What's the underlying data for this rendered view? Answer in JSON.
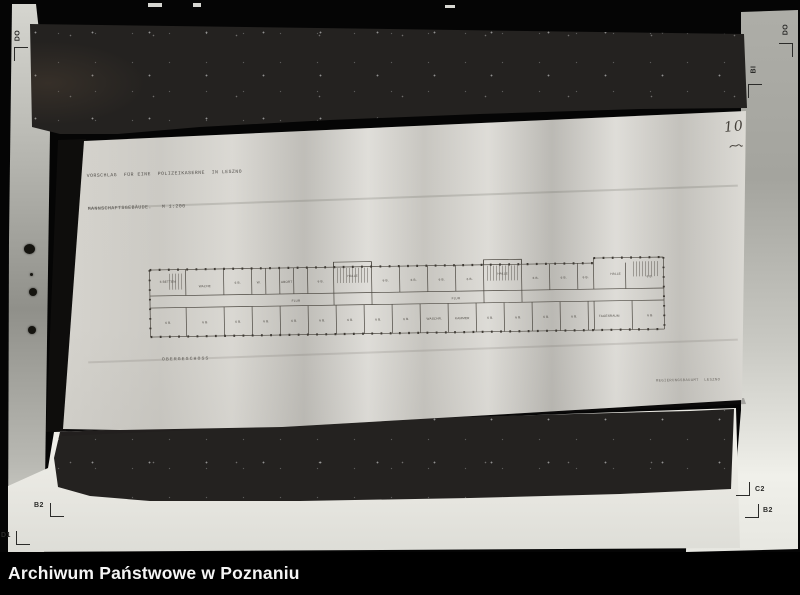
{
  "archive_bar": {
    "label": "Archiwum Państwowe w Poznaniu"
  },
  "paper": {
    "title_line1": "VORSCHLAG  FÜR EINE  POLIZEIKASERNE  IN LESZNO",
    "title_line2": "MANNSCHAFTSGEBÄUDE.   M 1:200",
    "floor_label": "OBERGESCHOSS",
    "office_label": "REGIERUNGSBAUAMT  LESZNO",
    "page_number": "10"
  },
  "registration_marks": {
    "top_left": "DO",
    "top_right": "DO",
    "right_mid": "BI",
    "bottom_left_upper": "B2",
    "bottom_left_lower": "D1",
    "bottom_right_upper": "C2",
    "bottom_right_lower": "B2"
  },
  "floor_plan": {
    "rooms": [
      {
        "x": 22,
        "y": 25,
        "t": "6 BETTEN"
      },
      {
        "x": 59,
        "y": 30,
        "t": "WACHE"
      },
      {
        "x": 92,
        "y": 27,
        "t": "6 B."
      },
      {
        "x": 113,
        "y": 27,
        "t": "W."
      },
      {
        "x": 141,
        "y": 27,
        "t": "ABORT"
      },
      {
        "x": 175,
        "y": 27,
        "t": "6 B."
      },
      {
        "x": 207,
        "y": 22,
        "t": "HALLE"
      },
      {
        "x": 240,
        "y": 27,
        "t": "6 B."
      },
      {
        "x": 268,
        "y": 27,
        "t": "6 B."
      },
      {
        "x": 296,
        "y": 27,
        "t": "6 B."
      },
      {
        "x": 324,
        "y": 27,
        "t": "6 B."
      },
      {
        "x": 357,
        "y": 22,
        "t": "HALLE"
      },
      {
        "x": 390,
        "y": 27,
        "t": "6 B."
      },
      {
        "x": 418,
        "y": 27,
        "t": "6 B."
      },
      {
        "x": 440,
        "y": 27,
        "t": "6 B."
      },
      {
        "x": 470,
        "y": 24,
        "t": "HALLE"
      },
      {
        "x": 504,
        "y": 27,
        "t": "6 B."
      },
      {
        "x": 150,
        "y": 46,
        "t": "FLUR"
      },
      {
        "x": 310,
        "y": 46,
        "t": "FLUR"
      },
      {
        "x": 22,
        "y": 66,
        "t": "6 B."
      },
      {
        "x": 59,
        "y": 66,
        "t": "6 B."
      },
      {
        "x": 92,
        "y": 66,
        "t": "6 B."
      },
      {
        "x": 120,
        "y": 66,
        "t": "6 B."
      },
      {
        "x": 148,
        "y": 66,
        "t": "6 B."
      },
      {
        "x": 176,
        "y": 66,
        "t": "6 B."
      },
      {
        "x": 204,
        "y": 66,
        "t": "6 B."
      },
      {
        "x": 232,
        "y": 66,
        "t": "6 B."
      },
      {
        "x": 260,
        "y": 66,
        "t": "6 B."
      },
      {
        "x": 288,
        "y": 66,
        "t": "WASCHR."
      },
      {
        "x": 316,
        "y": 66,
        "t": "KAMMER"
      },
      {
        "x": 344,
        "y": 66,
        "t": "6 B."
      },
      {
        "x": 372,
        "y": 66,
        "t": "6 B."
      },
      {
        "x": 400,
        "y": 66,
        "t": "6 B."
      },
      {
        "x": 428,
        "y": 66,
        "t": "6 B."
      },
      {
        "x": 463,
        "y": 66,
        "t": "TAGESRAUM"
      },
      {
        "x": 504,
        "y": 66,
        "t": "6 B."
      }
    ]
  },
  "colors": {
    "background": "#050505",
    "board": "#242220",
    "paper": "#d4d2cc",
    "mat": "#c6c6c0",
    "drawing_ink": "#4a463f",
    "caption_text": "#f5f5f5"
  }
}
